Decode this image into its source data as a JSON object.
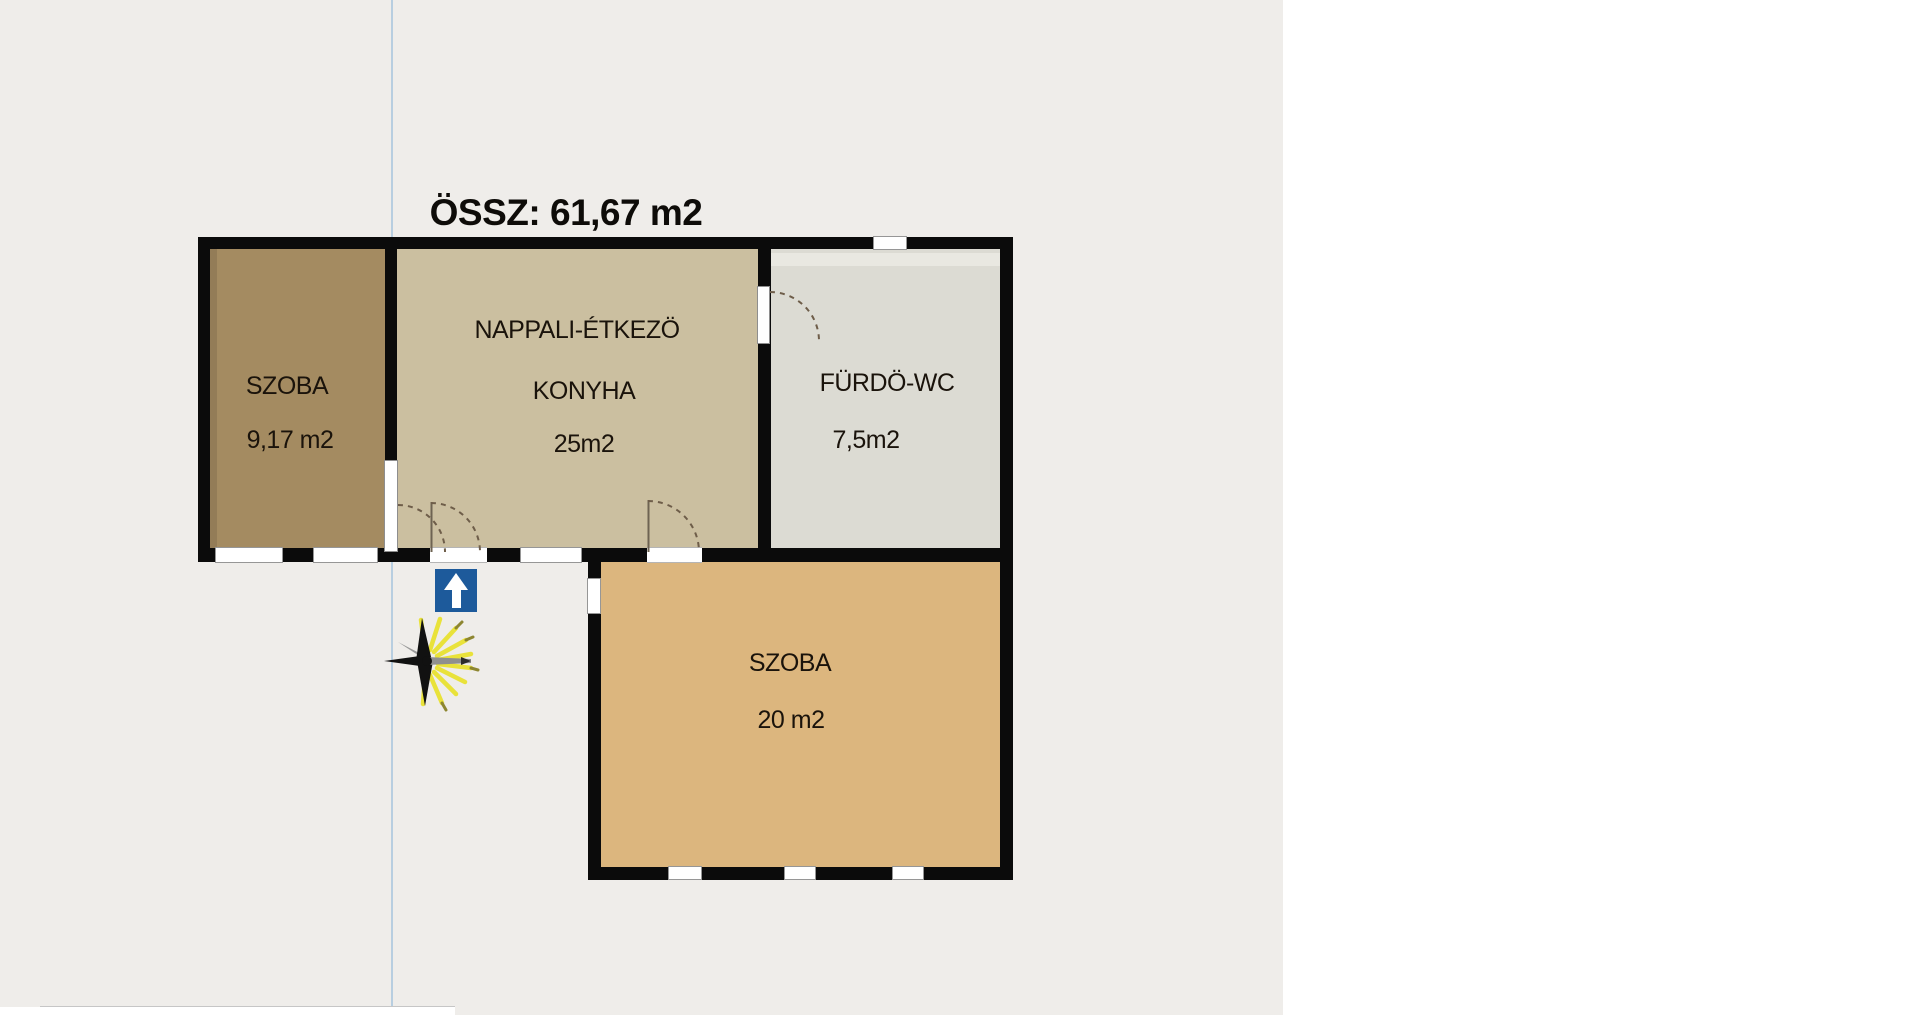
{
  "title": "ÖSSZ: 61,67 m2",
  "rooms": [
    {
      "name": "SZOBA",
      "area": "9,17 m2"
    },
    {
      "name": "NAPPALI-ÉTKEZÖ",
      "name2": "KONYHA",
      "area": "25m2"
    },
    {
      "name": "FÜRDÖ-WC",
      "area": "7,5m2"
    },
    {
      "name": "SZOBA",
      "area": "20 m2"
    }
  ],
  "symbols": {
    "entrance_arrow": "up-arrow-icon",
    "light_point": "starburst-icon"
  },
  "colors": {
    "background": "#efedea",
    "panel_right": "#ffffff",
    "wall": "#0b0b0b",
    "room_szoba1": "#a48b61",
    "room_nappali": "#cbbfa0",
    "room_furdo": "#dcdbd3",
    "room_furdo_stripe": "#e9e8e1",
    "room_szoba2": "#dcb67e",
    "guide_line": "#b8cee0",
    "arrow_blue": "#1d5a9b",
    "star_yellow": "#e9e23a"
  }
}
